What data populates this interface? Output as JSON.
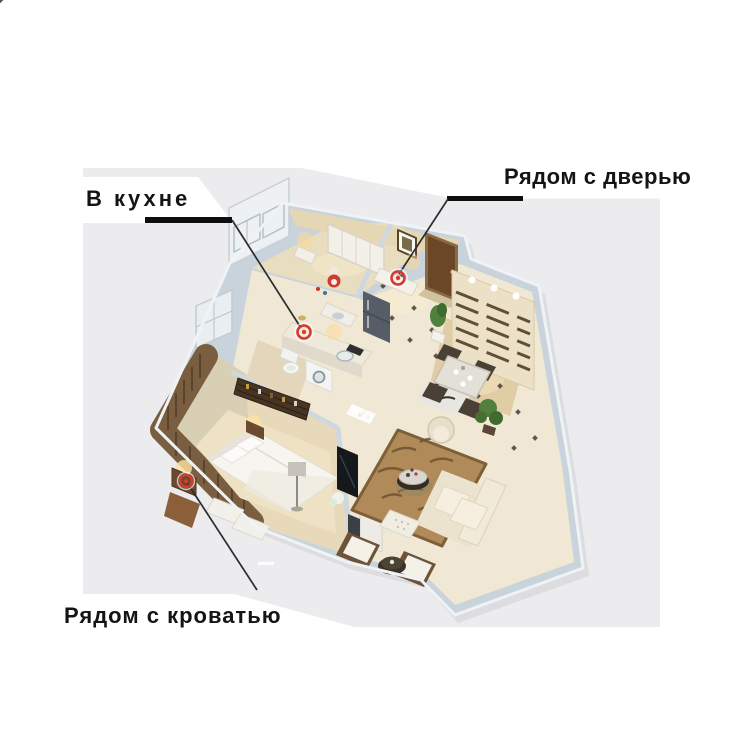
{
  "figure": {
    "kind": "annotated-3d-floorplan",
    "description": "3D isometric render of a one-bedroom apartment floor plan on a light gray photo background with three callout labels"
  },
  "annotations": [
    {
      "id": "in-kitchen",
      "label": "В кухне",
      "marker_transform": "translate(304,332)"
    },
    {
      "id": "near-door",
      "label": "Рядом с дверью",
      "marker_transform": "translate(398,278)"
    },
    {
      "id": "near-bed",
      "label": "Рядом с кроватью",
      "marker_transform": "translate(186,481)"
    }
  ],
  "colors": {
    "page_background": "#ffffff",
    "photo_background": "#ececee",
    "label_text": "#141414",
    "underline": "#0e0e0e",
    "leader_line": "#2c2c2c",
    "marker_red": "#d63b2f",
    "wall": "#c9d3db",
    "wall_top": "#eff3f6",
    "floor_warm": "#f0e8d4",
    "wood_dark": "#6b4728"
  },
  "scene": {
    "objects": [
      "wardrobe",
      "teddy-bear",
      "entry-door",
      "picture-frame",
      "console-table",
      "slatted-feature-wall",
      "dining-table",
      "dining-chairs",
      "potted-plants",
      "refrigerator",
      "kitchen-counter",
      "sink",
      "washing-machine",
      "toilet",
      "display-cabinet",
      "balcony-blinds",
      "double-bed",
      "pillows",
      "nightstand",
      "floor-lamp",
      "tv-screen",
      "tv-cabinet",
      "zebra-rug",
      "sofa",
      "armchair",
      "round-coffee-table",
      "ottoman",
      "lounge-chairs",
      "floor-tile-dots"
    ]
  }
}
